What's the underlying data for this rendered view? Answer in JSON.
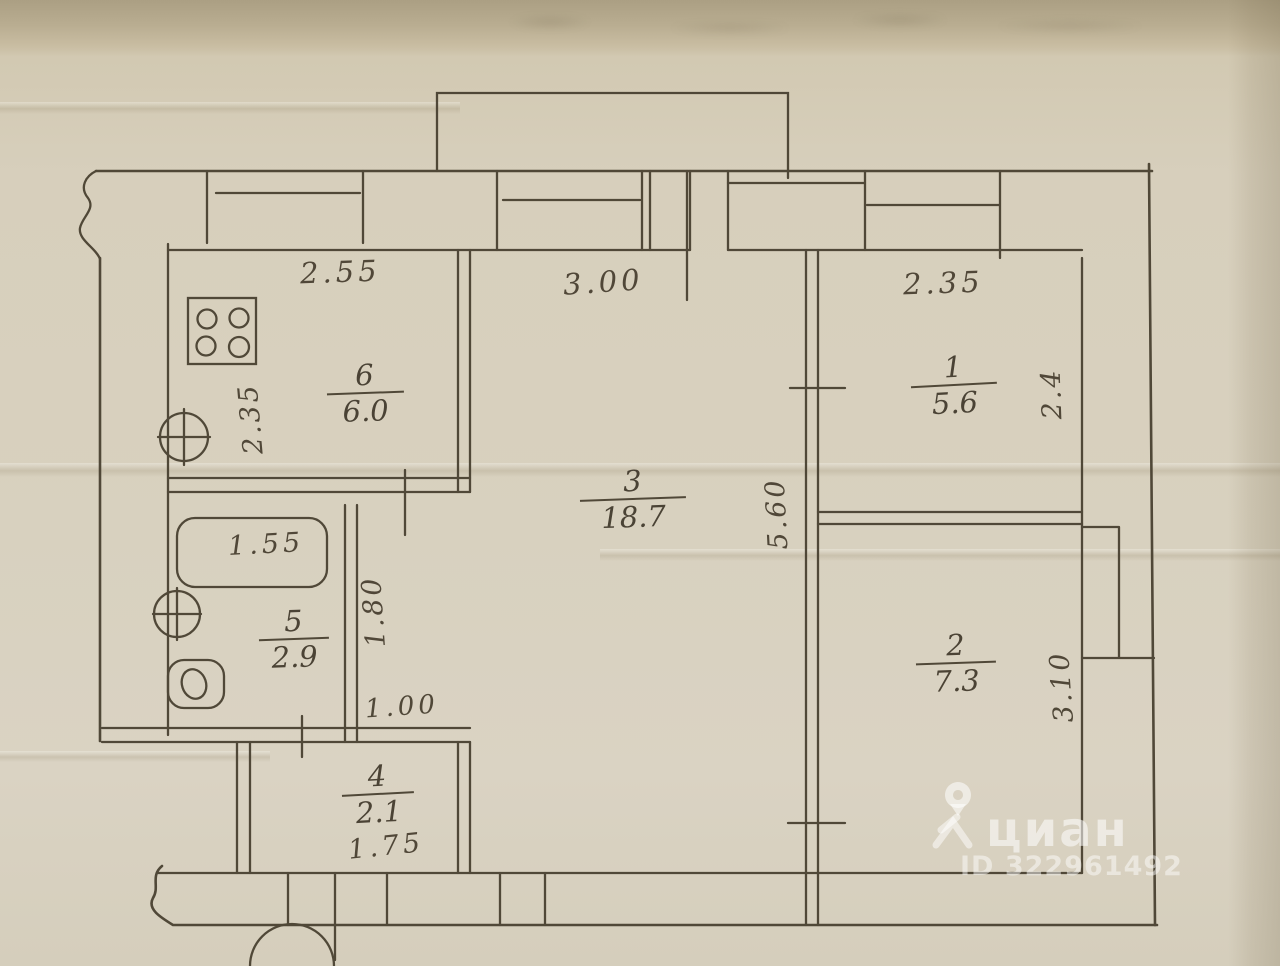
{
  "watermark": {
    "brand": "циан",
    "id": "ID 322961492"
  },
  "rooms": {
    "room1": {
      "number": "1",
      "area": "5.6",
      "width": "2.35",
      "depth": "2.4"
    },
    "room2": {
      "number": "2",
      "area": "7.3",
      "depth": "3.10"
    },
    "room3": {
      "number": "3",
      "area": "18.7",
      "width": "3.00",
      "depth": "5.60"
    },
    "room4": {
      "number": "4",
      "area": "2.1",
      "width": "1.75",
      "opening": "1.00"
    },
    "room5": {
      "number": "5",
      "area": "2.9",
      "bath": "1.55",
      "depth": "1.80"
    },
    "room6": {
      "number": "6",
      "area": "6.0",
      "width": "2.55",
      "depth": "2.35"
    }
  }
}
